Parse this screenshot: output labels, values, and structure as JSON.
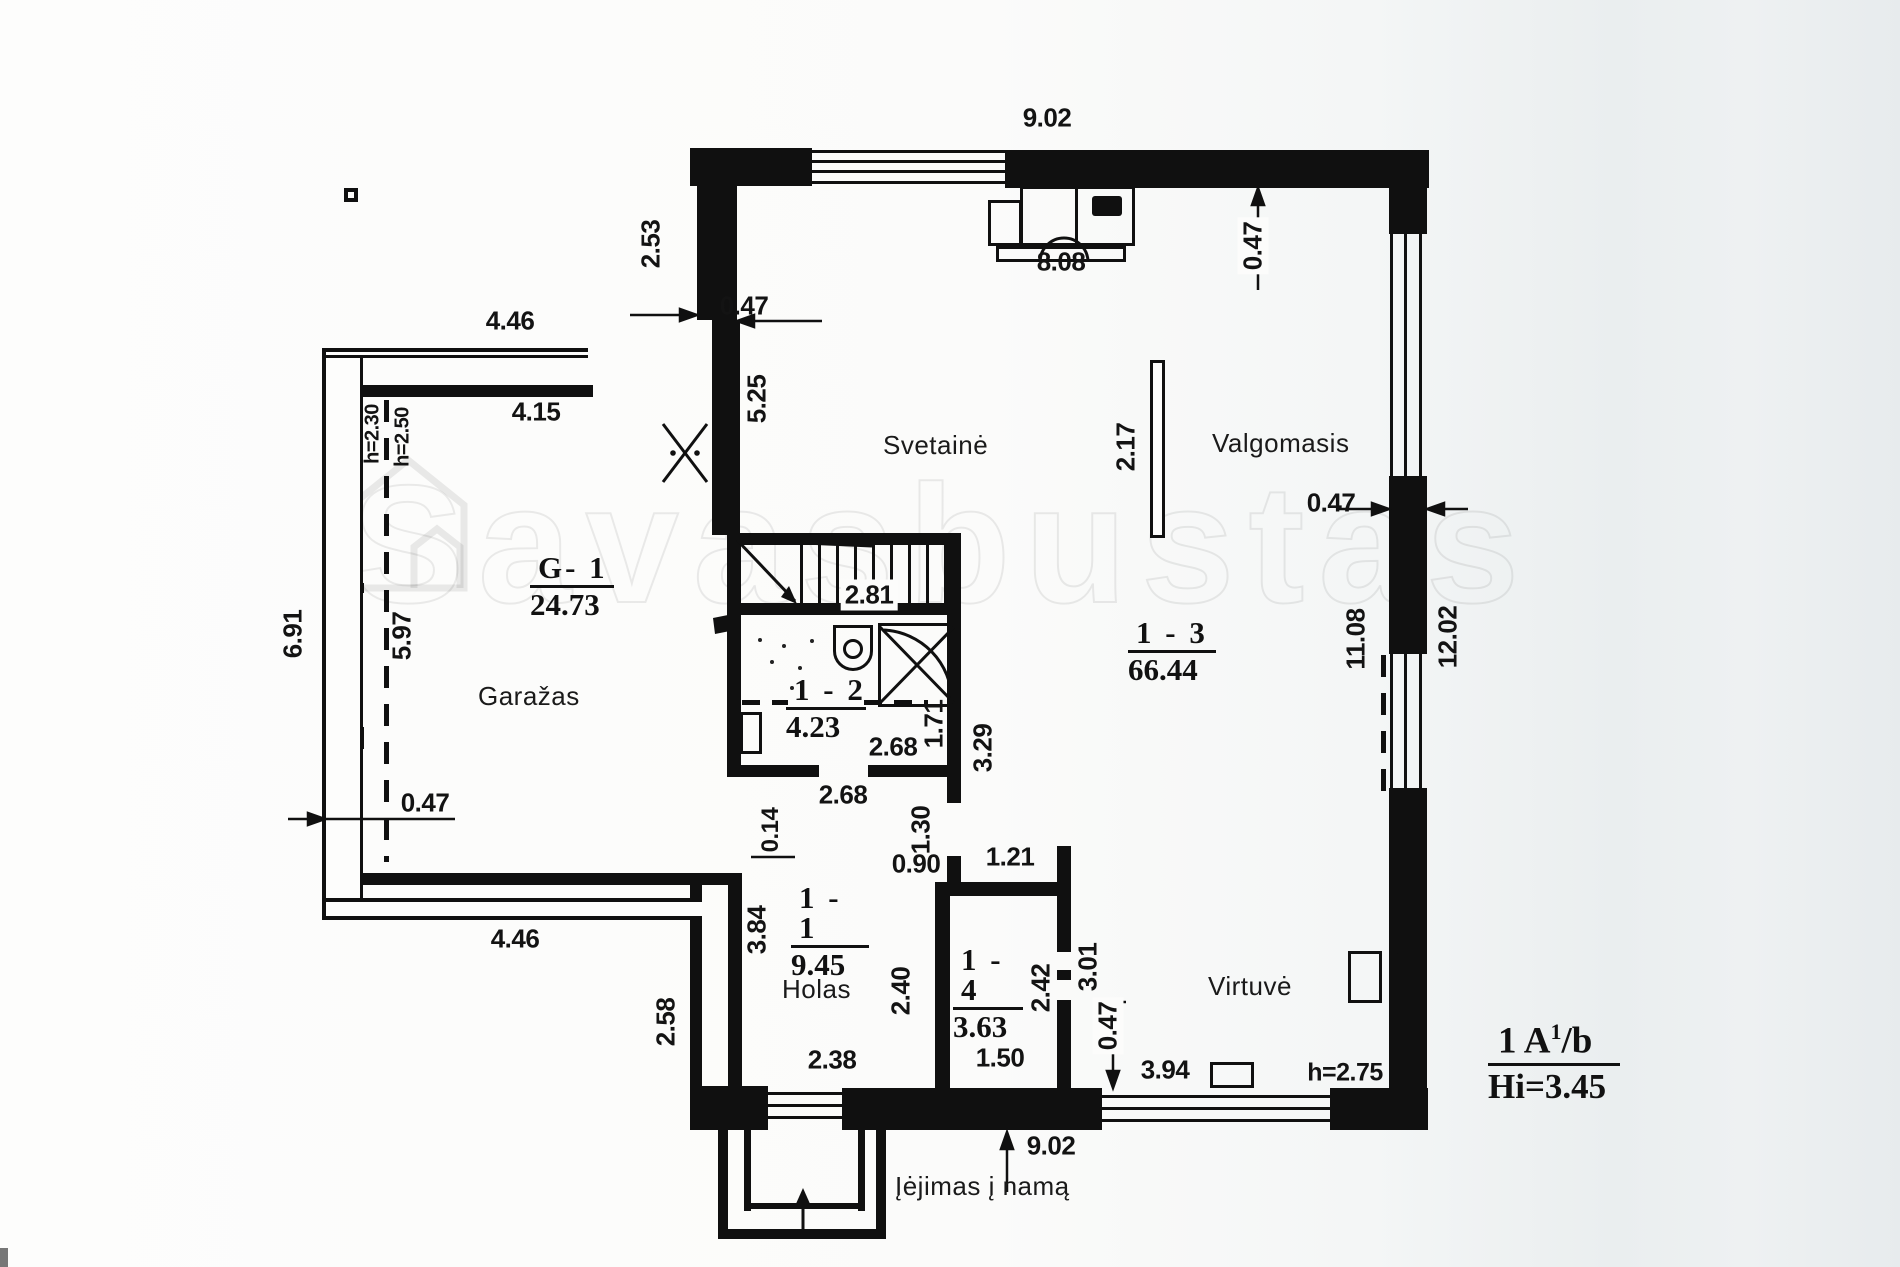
{
  "watermark": {
    "text": "Savasbustas"
  },
  "rooms": {
    "garage": {
      "code": "G- 1",
      "area": "24.73",
      "name": "Garažas"
    },
    "hall": {
      "code": "1 - 1",
      "area": "9.45",
      "name": "Holas"
    },
    "wc": {
      "code": "1 - 2",
      "area": "4.23"
    },
    "open13": {
      "code": "1 - 3",
      "area": "66.44"
    },
    "room14": {
      "code": "1 - 4",
      "area": "3.63"
    },
    "living": {
      "name": "Svetainė"
    },
    "dining": {
      "name": "Valgomasis"
    },
    "kitchen": {
      "name": "Virtuvė"
    }
  },
  "entrance": {
    "label": "Įėjimas į namą"
  },
  "title_block": {
    "floor": "1 A",
    "sup": "1",
    "suffix": "/b",
    "height": "Hi=3.45"
  },
  "dimensions": [
    {
      "v": "9.02",
      "x": 1047,
      "y": 118
    },
    {
      "v": "4.46",
      "x": 510,
      "y": 321
    },
    {
      "v": "0.47",
      "x": 744,
      "y": 306
    },
    {
      "v": "8.08",
      "x": 1061,
      "y": 262
    },
    {
      "v": "4.15",
      "x": 536,
      "y": 412
    },
    {
      "v": "0.47",
      "x": 1331,
      "y": 503
    },
    {
      "v": "2.81",
      "x": 869,
      "y": 595,
      "bg": true
    },
    {
      "v": "2.68",
      "x": 893,
      "y": 747
    },
    {
      "v": "2.68",
      "x": 843,
      "y": 795
    },
    {
      "v": "0.47",
      "x": 425,
      "y": 803
    },
    {
      "v": "4.46",
      "x": 515,
      "y": 939
    },
    {
      "v": "0.90",
      "x": 916,
      "y": 864
    },
    {
      "v": "1.21",
      "x": 1010,
      "y": 857
    },
    {
      "v": "2.38",
      "x": 832,
      "y": 1060
    },
    {
      "v": "1.50",
      "x": 1000,
      "y": 1058
    },
    {
      "v": "3.94",
      "x": 1165,
      "y": 1070
    },
    {
      "v": "h=2.75",
      "x": 1345,
      "y": 1073,
      "size": 25
    },
    {
      "v": "9.02",
      "x": 1051,
      "y": 1146
    },
    {
      "v": "2.53",
      "x": 651,
      "y": 244,
      "rot": true
    },
    {
      "v": "5.25",
      "x": 757,
      "y": 399,
      "rot": true
    },
    {
      "v": "2.17",
      "x": 1126,
      "y": 447,
      "rot": true
    },
    {
      "v": "0.47",
      "x": 1253,
      "y": 246,
      "rot": true,
      "bg": true
    },
    {
      "v": "h=2.30",
      "x": 373,
      "y": 434,
      "rot": true,
      "size": 20
    },
    {
      "v": "h=2.50",
      "x": 403,
      "y": 437,
      "rot": true,
      "size": 20
    },
    {
      "v": "6.91",
      "x": 293,
      "y": 634,
      "rot": true
    },
    {
      "v": "5.97",
      "x": 402,
      "y": 636,
      "rot": true
    },
    {
      "v": "1.71",
      "x": 934,
      "y": 724,
      "rot": true
    },
    {
      "v": "3.29",
      "x": 983,
      "y": 748,
      "rot": true
    },
    {
      "v": "0.14",
      "x": 771,
      "y": 830,
      "rot": true,
      "size": 24
    },
    {
      "v": "1.30",
      "x": 921,
      "y": 830,
      "rot": true
    },
    {
      "v": "3.84",
      "x": 757,
      "y": 930,
      "rot": true
    },
    {
      "v": "2.40",
      "x": 901,
      "y": 991,
      "rot": true
    },
    {
      "v": "2.58",
      "x": 666,
      "y": 1022,
      "rot": true
    },
    {
      "v": "2.42",
      "x": 1041,
      "y": 988,
      "rot": true
    },
    {
      "v": "3.01",
      "x": 1088,
      "y": 967,
      "rot": true
    },
    {
      "v": "0.47",
      "x": 1108,
      "y": 1026,
      "rot": true,
      "bg": true
    },
    {
      "v": "11.08",
      "x": 1356,
      "y": 639,
      "rot": true
    },
    {
      "v": "12.02",
      "x": 1448,
      "y": 637,
      "rot": true
    }
  ]
}
